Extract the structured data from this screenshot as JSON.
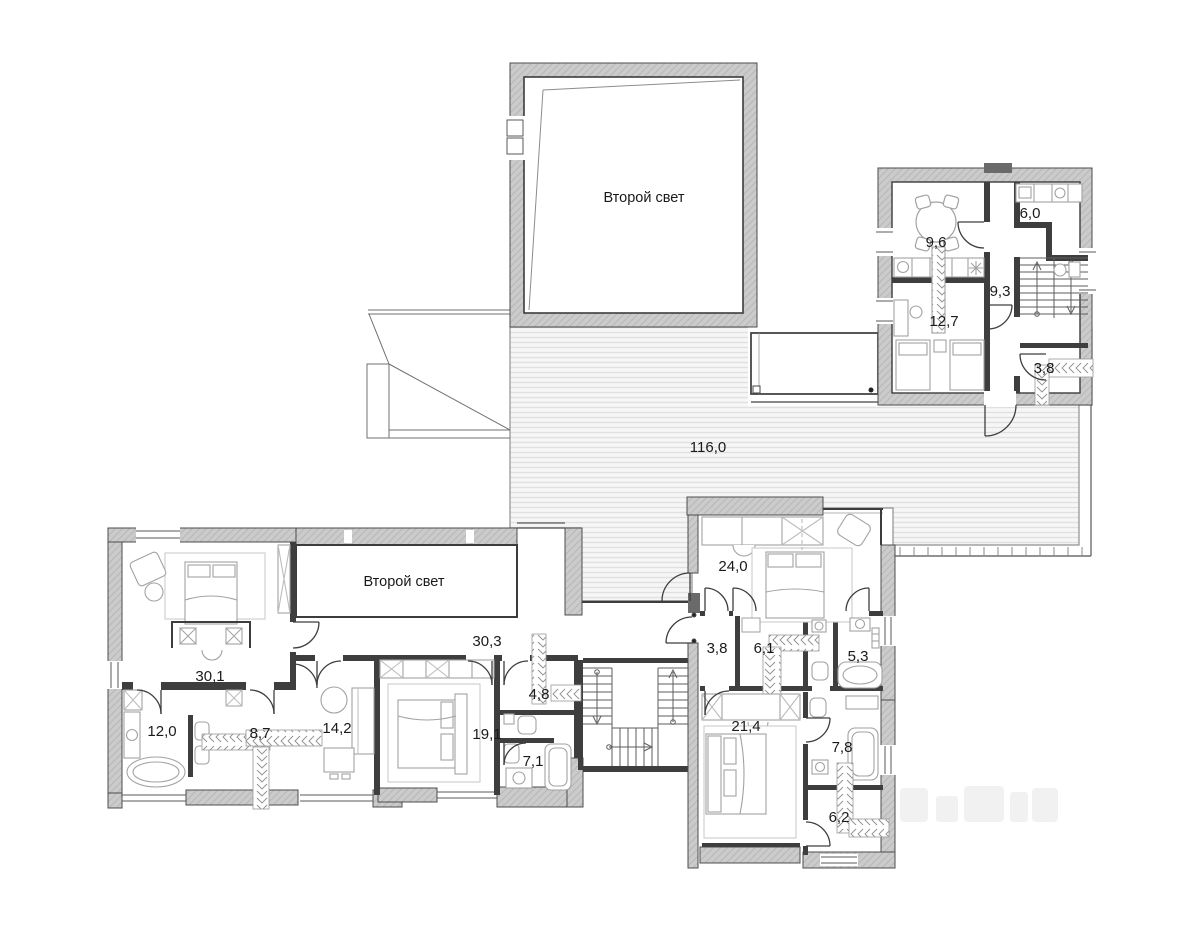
{
  "plan": {
    "labels": {
      "second_light_top": "Второй свет",
      "second_light_inner": "Второй свет",
      "terrace": "116,0",
      "r9_6": "9,6",
      "r6_0": "6,0",
      "r12_7": "12,7",
      "r9_3": "9,3",
      "r3_8_top": "3,8",
      "r30_1": "30,1",
      "r30_3": "30,3",
      "r12_0": "12,0",
      "r8_7": "8,7",
      "r14_2": "14,2",
      "r19_1": "19,1",
      "r4_8": "4,8",
      "r7_1": "7,1",
      "r24_0": "24,0",
      "r3_8_hall": "3,8",
      "r6_1": "6,1",
      "r5_3": "5,3",
      "r21_4": "21,4",
      "r7_8": "7,8",
      "r6_2": "6,2"
    },
    "colors": {
      "wall": "#cbcbcb",
      "wall_line": "#4d4d4d",
      "partition": "#3e3e3e",
      "deck_stripe": "#e2e2e2",
      "furniture": "#a2a2a2",
      "text": "#1a1a1a"
    }
  }
}
